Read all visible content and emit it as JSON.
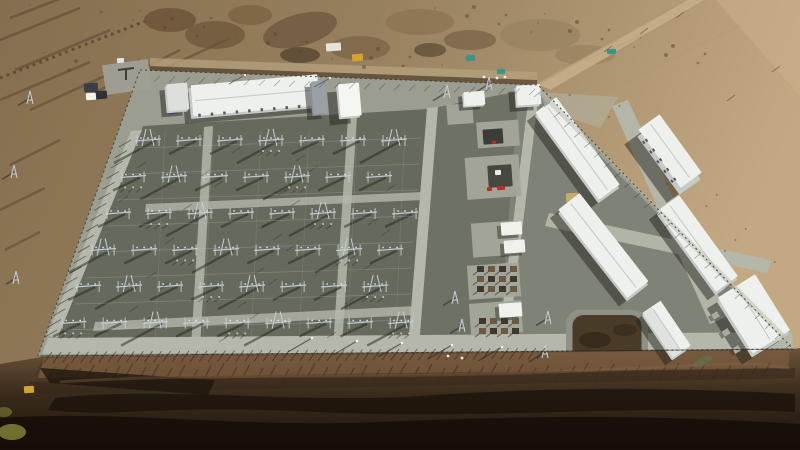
{
  "scene": {
    "type": "aerial-photograph",
    "subject": "high-voltage electrical substation and converter-station compound under construction",
    "setting": "barren desert plateau; eroded dark gullied badlands in the foreground, dirt roads and excavation works at the top",
    "lighting": "low sun from the upper right, long shadows cast toward lower left",
    "visible_text": ""
  },
  "palette": {
    "desertL": "#86704f",
    "desertR": "#c2a782",
    "rock": "#5a4530",
    "berm": "#5c4836",
    "roadTan": "#c3ab85",
    "apron": "#9b9d90",
    "roadLight": "#b4b7aa",
    "gravel": "#666a5d",
    "gravelC": "#6e7265",
    "rightYard": "#7e8277",
    "padC": "#a3a79a",
    "roofW": "#eef0ed",
    "wall": "#c6c9c6",
    "ridge": "#c2c8c9",
    "steel": "#c3ced6",
    "steelDot": "#e4eaed",
    "shadow": "#26261f",
    "fenceD": "#3b3b33",
    "pondBerm": "#8f9184",
    "pond": "#4a3a28",
    "slope": "#7c5e42",
    "badTop": "#6d5339",
    "badMid": "#3a2b1b",
    "badDark": "#201711",
    "gully": "#17100a",
    "yellow": "#d1a52f",
    "red": "#b23127",
    "blue": "#2f6fc4",
    "teal": "#37958a",
    "white": "#f2f3ef",
    "tan2": "#c9a96b",
    "grass": "#8f9040"
  },
  "buildings": [
    {
      "name": "control-building",
      "cx": 253,
      "cy": 98,
      "w": 127,
      "h": 31,
      "rot": -5,
      "reveal": 2.5,
      "shadow": [
        -6,
        5
      ],
      "ridge": "h",
      "features": [
        "doors"
      ]
    },
    {
      "name": "guard-house",
      "cx": 176,
      "cy": 99,
      "w": 21,
      "h": 27,
      "rot": -5,
      "reveal": 2,
      "shadow": [
        -5,
        4
      ],
      "roof": "#dcdfdc"
    },
    {
      "name": "annex",
      "cx": 318,
      "cy": 99,
      "w": 14,
      "h": 33,
      "rot": -5,
      "reveal": 1.5,
      "shadow": [
        -5,
        4
      ],
      "roof": "#9aa0a5",
      "wall": "#8b9196"
    },
    {
      "name": "tower-structure",
      "cx": 348,
      "cy": 102,
      "w": 21,
      "h": 33,
      "rot": -5,
      "reveal": 2,
      "shadow": [
        -9,
        6
      ],
      "roof": "#f4f6f3"
    },
    {
      "name": "north-cabin",
      "cx": 473,
      "cy": 100,
      "w": 21,
      "h": 14,
      "rot": -4,
      "reveal": 1.5,
      "shadow": [
        -4,
        3
      ]
    },
    {
      "name": "utility-building",
      "cx": 527,
      "cy": 97,
      "w": 24,
      "h": 20,
      "rot": -4,
      "reveal": 2,
      "shadow": [
        -6,
        4
      ]
    },
    {
      "name": "valve-hall-a",
      "cx": 577,
      "cy": 152,
      "w": 26,
      "h": 108,
      "rot": -36,
      "reveal": 2.5,
      "shadow": [
        -8,
        5
      ],
      "ridge": "v"
    },
    {
      "name": "valve-hall-b",
      "cx": 603,
      "cy": 249,
      "w": 27,
      "h": 112,
      "rot": -38,
      "reveal": 2.5,
      "shadow": [
        -8,
        5
      ],
      "ridge": "v"
    },
    {
      "name": "office-building",
      "cx": 669,
      "cy": 158,
      "w": 26,
      "h": 72,
      "rot": -36,
      "reveal": 5,
      "shadow": [
        -13,
        8
      ],
      "ridge": "v",
      "features": [
        "windows"
      ]
    },
    {
      "name": "valve-hall-c",
      "cx": 697,
      "cy": 247,
      "w": 27,
      "h": 100,
      "rot": -36,
      "reveal": 2.5,
      "shadow": [
        -8,
        5
      ],
      "ridge": "v"
    },
    {
      "name": "pump-house",
      "cx": 666,
      "cy": 332,
      "w": 22,
      "h": 54,
      "rot": -34,
      "reveal": 2,
      "shadow": [
        -7,
        5
      ],
      "ridge": "v",
      "features": [
        "gable"
      ]
    },
    {
      "name": "warehouse",
      "cx": 753,
      "cy": 318,
      "w": 44,
      "h": 66,
      "rot": -32,
      "reveal": 3,
      "shadow": [
        -10,
        7
      ],
      "ridge": "v",
      "features": [
        "units"
      ]
    }
  ],
  "pads": [
    {
      "x": 447,
      "y": 104,
      "w": 26,
      "h": 20
    },
    {
      "x": 477,
      "y": 121,
      "w": 42,
      "h": 26
    },
    {
      "x": 466,
      "y": 156,
      "w": 54,
      "h": 42
    },
    {
      "x": 472,
      "y": 222,
      "w": 46,
      "h": 34
    },
    {
      "x": 468,
      "y": 264,
      "w": 52,
      "h": 34
    },
    {
      "x": 470,
      "y": 302,
      "w": 52,
      "h": 32
    },
    {
      "x": 104,
      "y": 62,
      "w": 46,
      "h": 30,
      "c": "#a09f96",
      "rot": -8
    }
  ],
  "boxes": [
    {
      "x": 483,
      "y": 129,
      "w": 20,
      "h": 15,
      "c": "#3c3d37",
      "n": "transformer"
    },
    {
      "x": 488,
      "y": 165,
      "w": 24,
      "h": 22,
      "c": "#46473f",
      "n": "main-transformer"
    },
    {
      "x": 495,
      "y": 170,
      "w": 6,
      "h": 5,
      "c": "#e9ebe7",
      "n": "transformer-top"
    },
    {
      "x": 497,
      "y": 186,
      "w": 8,
      "h": 4,
      "c": "#b23127",
      "n": "fire-system"
    },
    {
      "x": 487,
      "y": 187,
      "w": 5,
      "h": 4,
      "c": "#b23127",
      "n": "fire-system"
    },
    {
      "x": 492,
      "y": 141,
      "w": 4,
      "h": 3,
      "c": "#b23127",
      "n": "valve"
    },
    {
      "x": 501,
      "y": 222,
      "w": 21,
      "h": 13,
      "c": "#f0f1ed",
      "n": "equipment-cabin",
      "sh": 1
    },
    {
      "x": 504,
      "y": 240,
      "w": 21,
      "h": 13,
      "c": "#f0f1ed",
      "n": "equipment-cabin",
      "sh": 1
    },
    {
      "x": 499,
      "y": 303,
      "w": 23,
      "h": 14,
      "c": "#f0f1ed",
      "n": "equipment-cabin",
      "sh": 1
    },
    {
      "x": 167,
      "y": 106,
      "w": 11,
      "h": 8,
      "c": "#2f6fc4",
      "n": "container-blue"
    },
    {
      "x": 566,
      "y": 193,
      "w": 12,
      "h": 9,
      "c": "#c9a96b",
      "n": "sand-pile"
    },
    {
      "x": 326,
      "y": 43,
      "w": 15,
      "h": 8,
      "c": "#e6e3da",
      "n": "tarp"
    },
    {
      "x": 352,
      "y": 54,
      "w": 11,
      "h": 7,
      "c": "#d1a52f",
      "n": "excavator"
    },
    {
      "x": 466,
      "y": 55,
      "w": 9,
      "h": 6,
      "c": "#37958a",
      "n": "container-teal"
    },
    {
      "x": 497,
      "y": 69,
      "w": 8,
      "h": 5,
      "c": "#37958a",
      "n": "container-teal"
    },
    {
      "x": 607,
      "y": 49,
      "w": 9,
      "h": 5,
      "c": "#37958a",
      "n": "container-teal"
    },
    {
      "x": 84,
      "y": 83,
      "w": 14,
      "h": 9,
      "c": "#3a3f45",
      "n": "truck"
    },
    {
      "x": 95,
      "y": 91,
      "w": 12,
      "h": 8,
      "c": "#2e3237",
      "n": "truck"
    },
    {
      "x": 86,
      "y": 93,
      "w": 10,
      "h": 7,
      "c": "#f2f3ef",
      "n": "container-white"
    },
    {
      "x": 117,
      "y": 58,
      "w": 7,
      "h": 5,
      "c": "#dfe3e6",
      "n": "van"
    },
    {
      "x": 24,
      "y": 386,
      "w": 10,
      "h": 7,
      "c": "#d1a52f",
      "n": "excavator"
    }
  ],
  "clusters": [
    {
      "x": 477,
      "y": 266,
      "cols": 4,
      "rows": 3,
      "sx": 11,
      "sy": 10,
      "w": 7,
      "h": 6
    },
    {
      "x": 479,
      "y": 318,
      "cols": 4,
      "rows": 2,
      "sx": 11,
      "sy": 10,
      "w": 7,
      "h": 6
    }
  ],
  "masts": [
    {
      "x": 447,
      "y": 92,
      "s": 14
    },
    {
      "x": 489,
      "y": 84,
      "s": 18
    },
    {
      "x": 455,
      "y": 298,
      "s": 12
    },
    {
      "x": 462,
      "y": 326,
      "s": 12
    },
    {
      "x": 545,
      "y": 352,
      "s": 16
    },
    {
      "x": 548,
      "y": 318,
      "s": 12
    },
    {
      "x": 30,
      "y": 98,
      "s": 12
    },
    {
      "x": 14,
      "y": 172,
      "s": 12
    },
    {
      "x": 16,
      "y": 278,
      "s": 10
    }
  ],
  "yard": {
    "rows": 6,
    "y0": 140,
    "rowGap": 36.5,
    "colGap": 41,
    "x0": 136,
    "leftSlope": 0.41,
    "xmax": 424,
    "rightSlope": 0.07,
    "extraTicks": 36,
    "conductorsH": 8,
    "conductorsV": 6
  },
  "combs": [
    {
      "x1": 52,
      "y1": 352,
      "x2": 545,
      "y2": 348,
      "n": 55,
      "dx": -8,
      "dy": 11,
      "w": 0.9,
      "o": 0.6
    },
    {
      "x1": 131,
      "y1": 140,
      "x2": 57,
      "y2": 330,
      "n": 19,
      "dx": -12,
      "dy": 7,
      "w": 0.9,
      "o": 0.55
    },
    {
      "x1": 160,
      "y1": 76,
      "x2": 535,
      "y2": 89,
      "n": 26,
      "dx": -6,
      "dy": 6,
      "w": 0.8,
      "o": 0.35
    },
    {
      "x1": 540,
      "y1": 92,
      "x2": 791,
      "y2": 344,
      "n": 26,
      "dx": -6,
      "dy": 5,
      "w": 0.8,
      "o": 0.4
    }
  ],
  "poles": {
    "south": [
      [
        312,
        338
      ],
      [
        357,
        341
      ],
      [
        402,
        343
      ],
      [
        452,
        345
      ],
      [
        502,
        347
      ]
    ],
    "north": [
      [
        245,
        75
      ],
      [
        330,
        78
      ]
    ],
    "road_ticks": [
      [
        612,
        46
      ],
      [
        648,
        28
      ],
      [
        684,
        12
      ],
      [
        735,
        95
      ],
      [
        780,
        66
      ]
    ]
  },
  "workers": [
    [
      448,
      356
    ],
    [
      462,
      358
    ],
    [
      484,
      77
    ],
    [
      497,
      78
    ],
    [
      505,
      77
    ]
  ],
  "desert_texture": {
    "top_dots": 46,
    "east_dots": 14
  },
  "rills": {
    "x1": 42,
    "x2": 775,
    "step": 13,
    "y": 363
  }
}
